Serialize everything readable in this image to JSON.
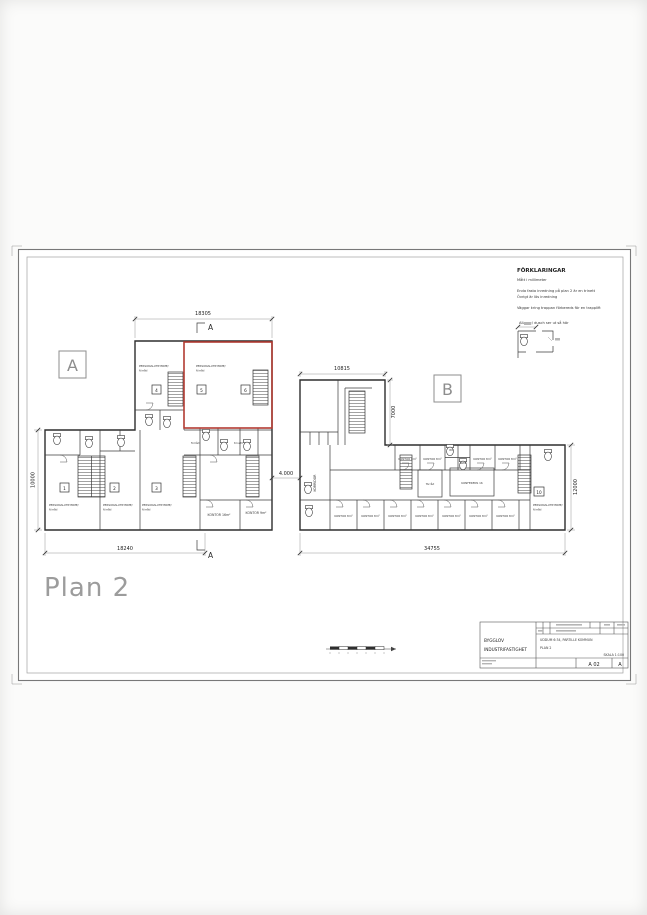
{
  "plan": {
    "title": "Plan 2"
  },
  "legend": {
    "title": "FÖRKLARINGAR",
    "note_units": "Mått i millimeter",
    "note_fixed_1": "Enda fasta inredning på plan 2 är en trinett",
    "note_fixed_2": "Övrigt är lös inredning",
    "note_stairs": "Väggar kring trappan förbereds för en trapplift",
    "note_wc": "Alla wc/ dusch ser ut så här"
  },
  "markers": {
    "building_a": "A",
    "building_b": "B",
    "section": "A"
  },
  "dimensions": {
    "a_top": "18305",
    "a_bottom": "18240",
    "a_left": "10000",
    "gap": "4.000",
    "b_top": "10815",
    "b_wing": "7000",
    "b_right": "12000",
    "b_bottom": "34755"
  },
  "rooms": {
    "personal": "PERSONALUTRYMME/",
    "personal_sub": "förråd",
    "kontor_16": "KONTOR 16m²",
    "kontor_9": "KONTOR 9m²",
    "kontor_8": "KONTOR 8m²",
    "korridor": "KORRIDOR",
    "konferens": "KONFERENS 16",
    "forrad": "förråd",
    "trinett": "trinett",
    "wc": "WC",
    "rwc": "RWC",
    "units": [
      "1",
      "2",
      "3",
      "4",
      "5",
      "6",
      "10"
    ]
  },
  "title_block": {
    "client_1": "BYGGLOV",
    "client_2": "INDUSTRIFASTIGHET",
    "project": "UDDUM 6:34, PARTILLE KOMMUN",
    "drawing_name": "PLAN 2",
    "scale": "SKALA 1:100",
    "drawing_no": "A 02",
    "revision": "A"
  }
}
